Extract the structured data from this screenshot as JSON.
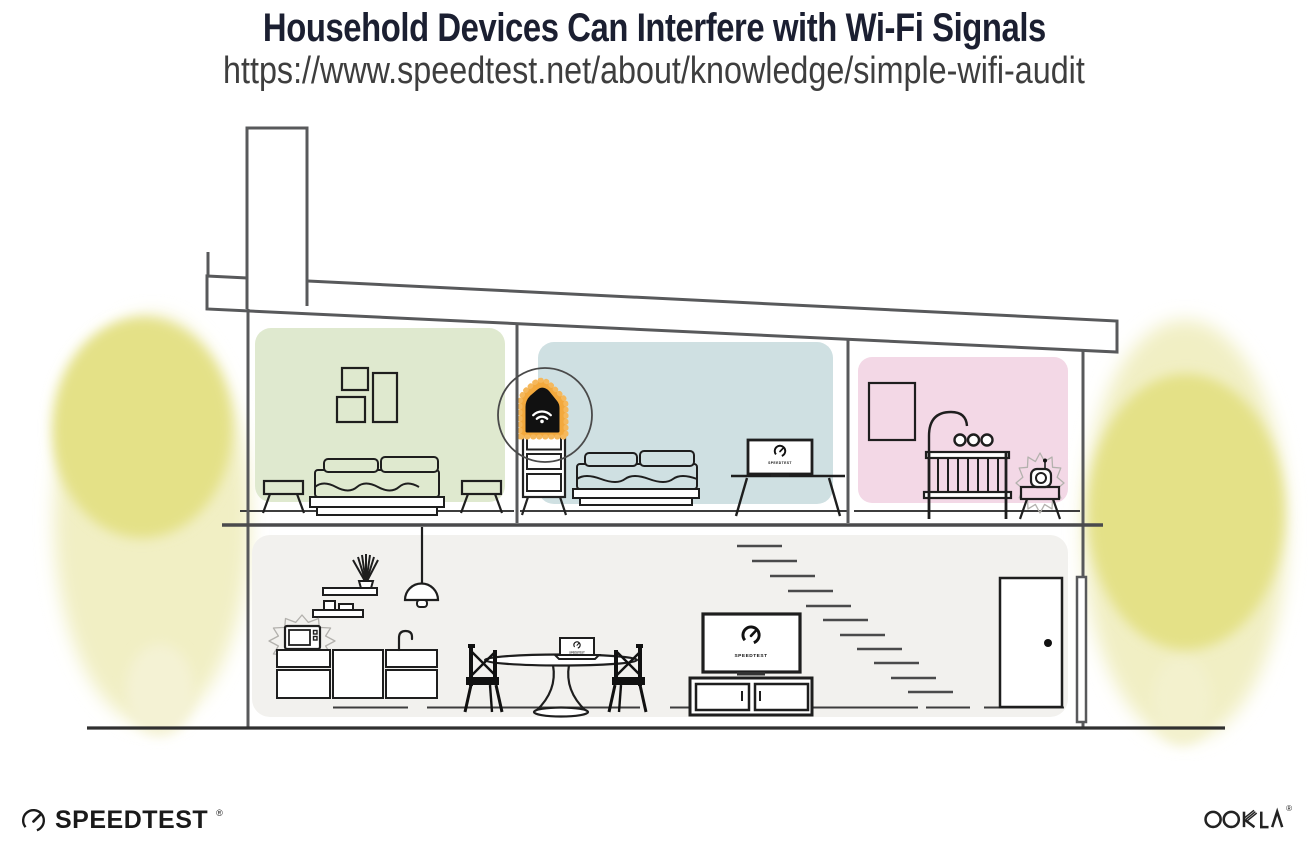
{
  "page": {
    "title": "Household Devices Can Interfere with Wi-Fi Signals",
    "url": "https://www.speedtest.net/about/knowledge/simple-wifi-audit"
  },
  "branding": {
    "speedtest_wordmark": "SPEEDTEST",
    "speedtest_reg_mark": "®",
    "ookla_wordmark": "OOKLA",
    "ookla_reg_mark": "®"
  },
  "illustration": {
    "screens": {
      "living_room_tv_label": "SPEEDTEST",
      "bedroom_tv_label": "SPEEDTEST",
      "laptop_label": "SPEEDTEST"
    },
    "icons": [
      "wifi-router-icon",
      "speedtest-gauge-icon",
      "microwave-icon",
      "baby-monitor-icon",
      "interference-burst-icon",
      "tree-icon",
      "pendant-lamp-icon",
      "plant-icon"
    ],
    "objects": [
      "chimney",
      "sloped-roof",
      "green-bedroom",
      "blue-bedroom",
      "pink-nursery",
      "ground-floor",
      "wall-art-frames",
      "bed",
      "nightstool",
      "wifi-router-on-dresser",
      "highlight-circle",
      "bedroom-tv-on-stand",
      "picture-frame",
      "crib",
      "baby-mobile",
      "baby-monitor-on-table",
      "kitchen-shelves",
      "plant",
      "pendant-lamp",
      "microwave",
      "kitchen-counter",
      "faucet",
      "dining-table",
      "laptop",
      "dining-chairs",
      "living-room-tv",
      "media-console",
      "stairs",
      "front-door",
      "downspout",
      "yard-trees"
    ],
    "colors": {
      "bedroom_green": "#dfe9cf",
      "bedroom_blue": "#cfe0e2",
      "nursery_pink": "#f3d8e6",
      "ground_floor_gray": "#f2f1ee",
      "tree_core_yellow": "#e4e187",
      "tree_halo_yellow": "#f1efc4",
      "router_highlight_orange": "#f3a93d",
      "structure_gray": "#58595b",
      "ink_black": "#1e1e1e",
      "title_navy": "#1b1f31",
      "url_gray": "#3e3e3e"
    }
  }
}
